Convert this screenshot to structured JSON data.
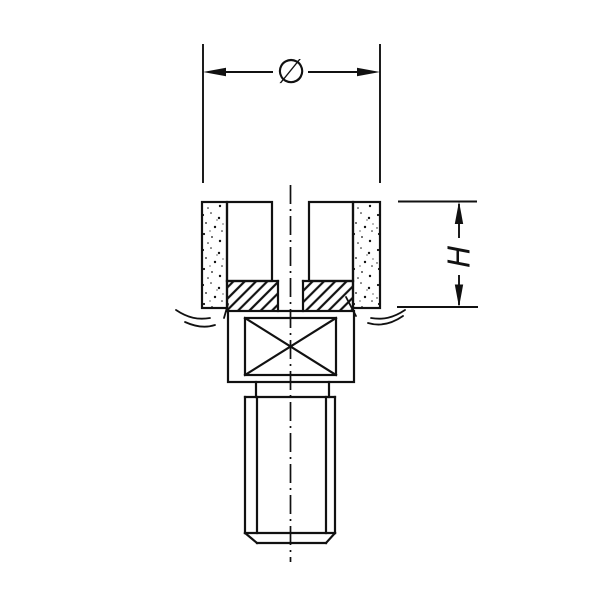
{
  "drawing": {
    "type": "technical-drawing",
    "subject": "mounted grinding cup wheel with threaded shank",
    "labels": {
      "diameter_symbol": "∅",
      "height_symbol": "H"
    },
    "colors": {
      "background": "#ffffff",
      "ink": "#111111"
    }
  }
}
